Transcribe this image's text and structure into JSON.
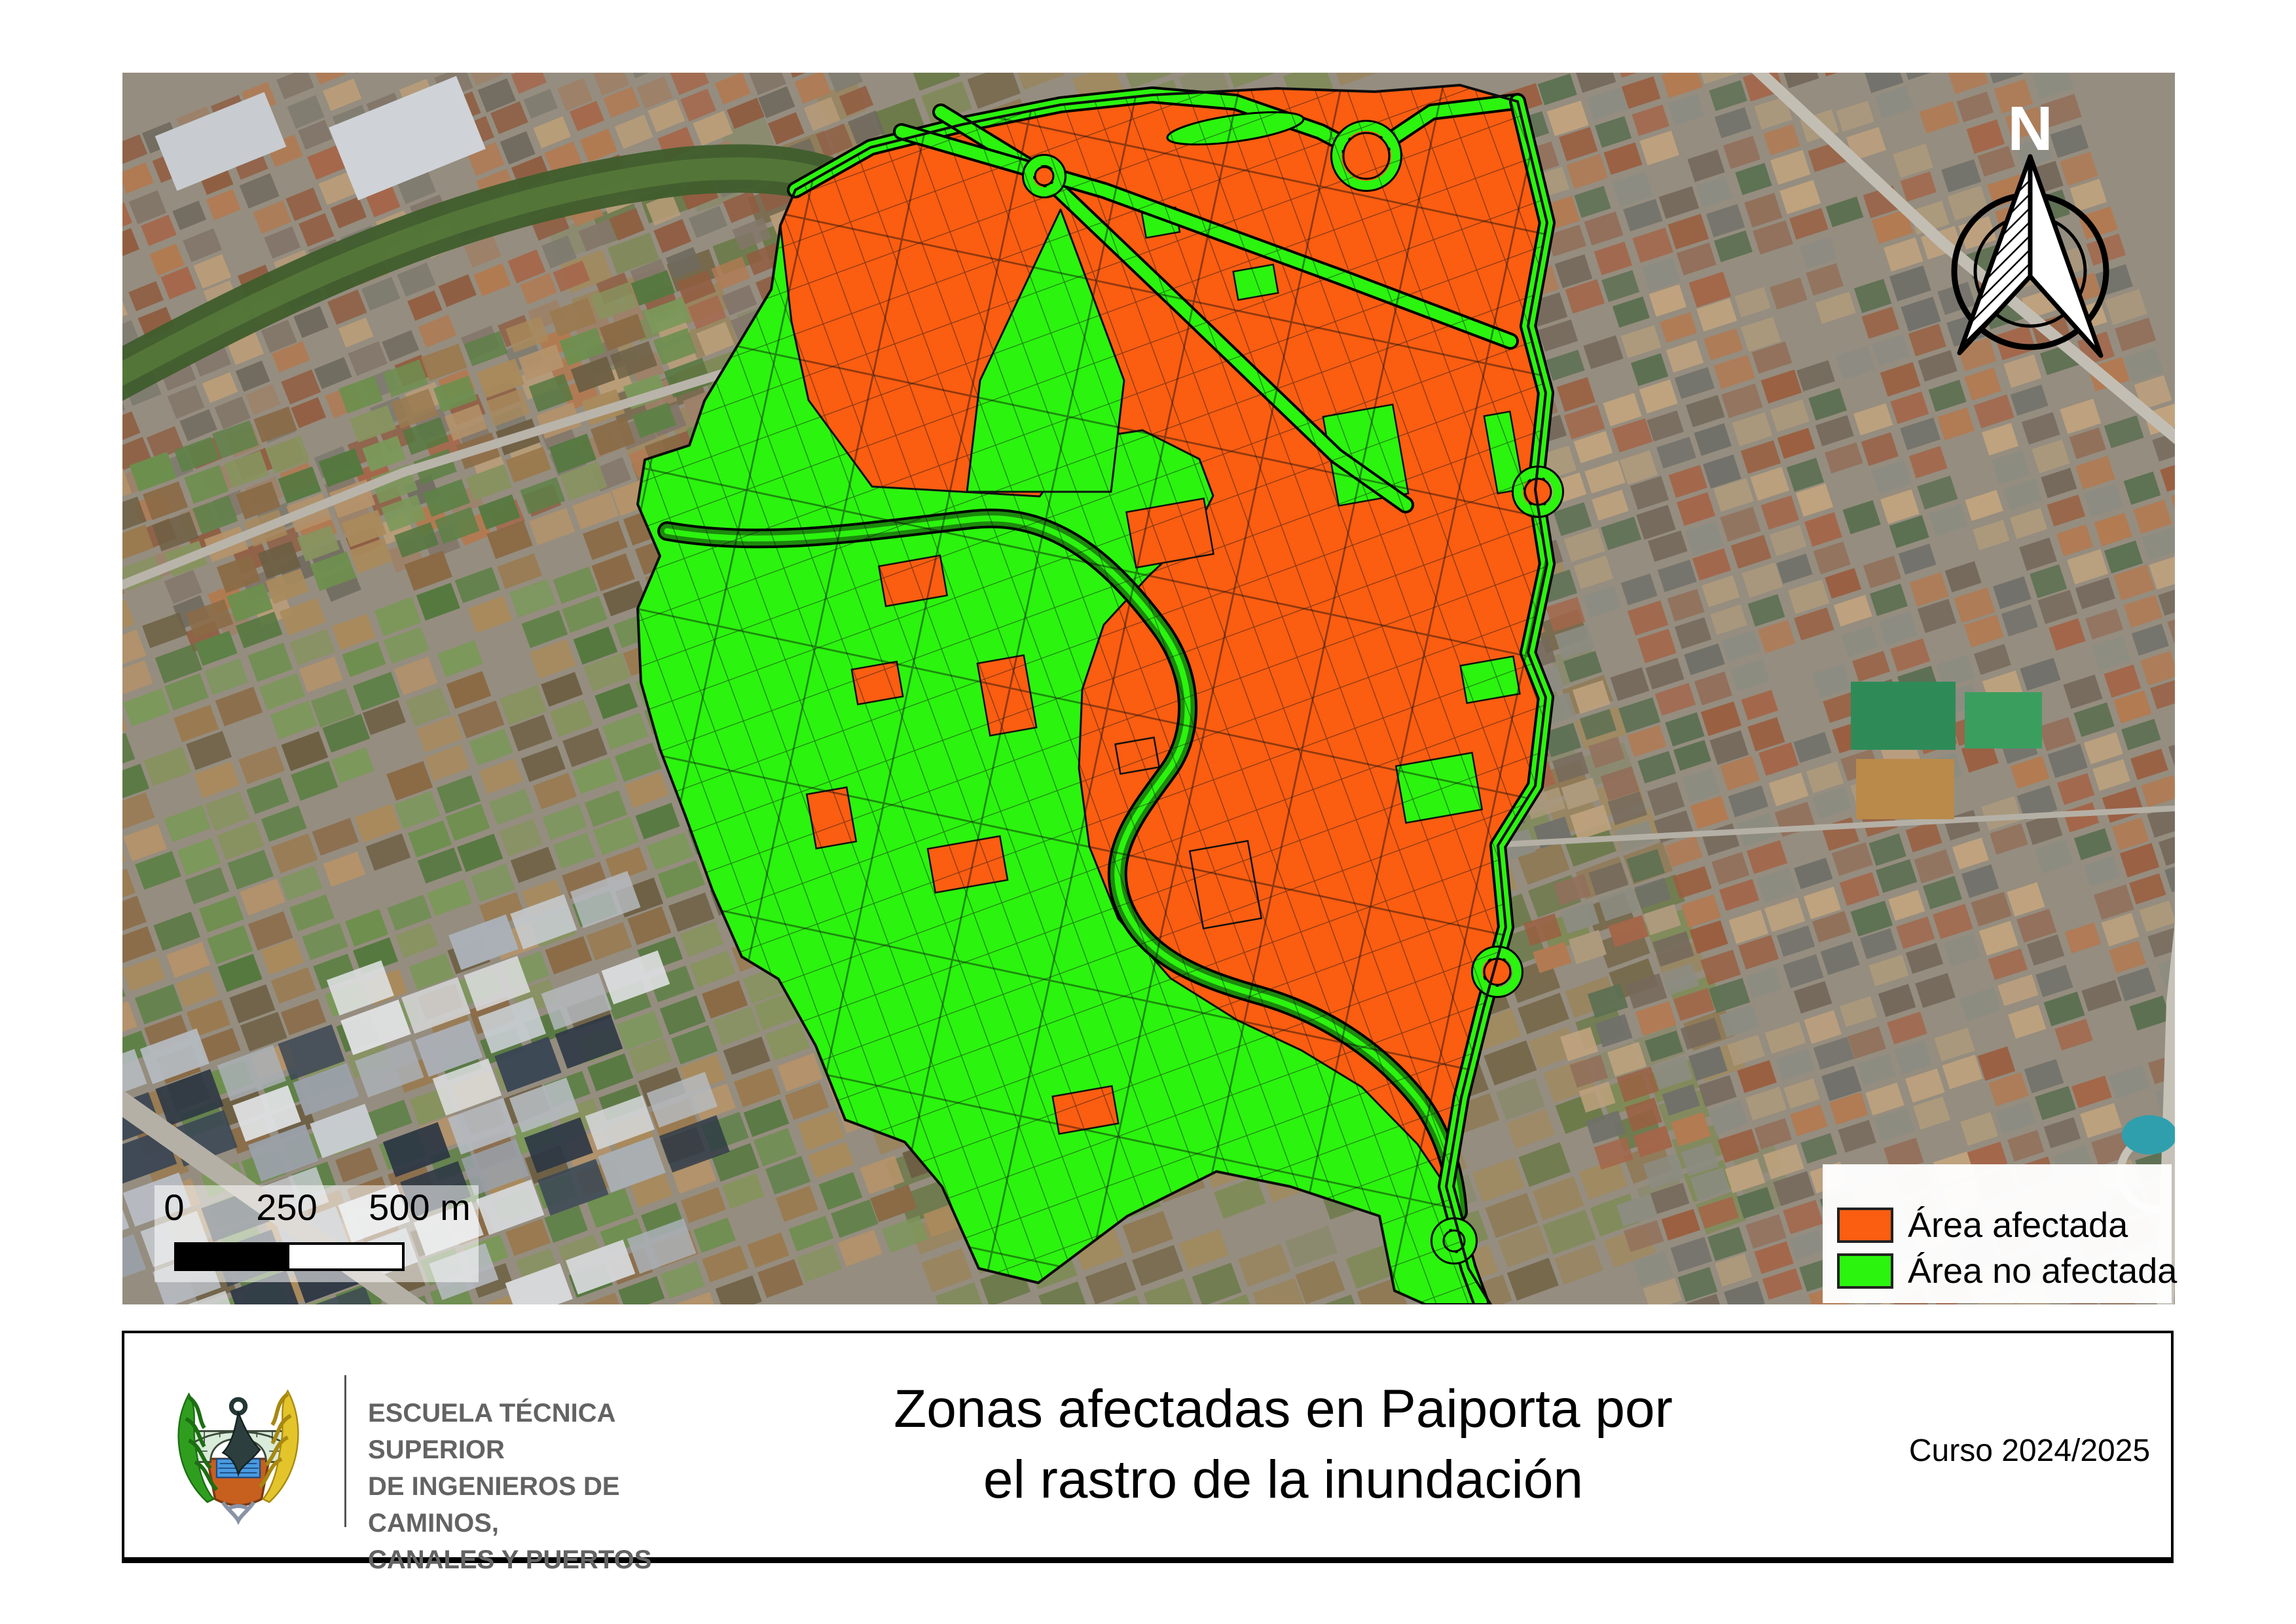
{
  "north": {
    "label": "N"
  },
  "scalebar": {
    "tick0": "0",
    "tick1": "250",
    "tick2": "500 m"
  },
  "legend": {
    "items": [
      {
        "label": "Área afectada",
        "color": "#fb5d11"
      },
      {
        "label": "Área no afectada",
        "color": "#2bf40e"
      }
    ]
  },
  "colors": {
    "affected": "#fb5d11",
    "not_affected": "#2bf40e",
    "parcel_line": "#1a1a1a",
    "road_green": "#2bf40e",
    "river_green": "#1c8a0c"
  },
  "footer": {
    "school_line1": "ESCUELA TÉCNICA SUPERIOR",
    "school_line2": "DE INGENIEROS DE CAMINOS,",
    "school_line3": "CANALES Y PUERTOS",
    "title_line1": "Zonas afectadas en Paiporta por",
    "title_line2": "el rastro de la inundación",
    "course": "Curso 2024/2025"
  }
}
